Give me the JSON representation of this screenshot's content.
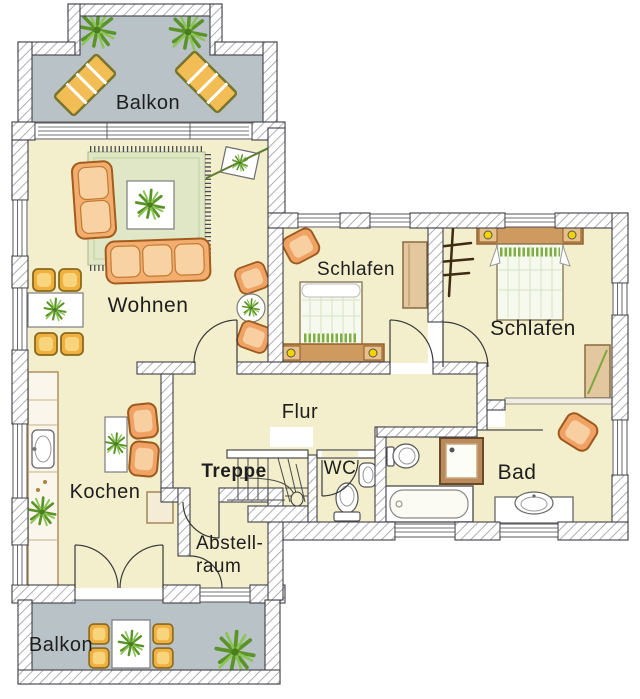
{
  "labels": {
    "balkon_top": "Balkon",
    "wohnen": "Wohnen",
    "schlafen_small": "Schlafen",
    "schlafen_large": "Schlafen",
    "flur": "Flur",
    "treppe": "Treppe",
    "wc": "WC",
    "bad": "Bad",
    "kochen": "Kochen",
    "abstellraum_line1": "Abstell-",
    "abstellraum_line2": "raum",
    "balkon_bottom": "Balkon"
  },
  "colors": {
    "room_floor": "#f3eecb",
    "balcony_floor": "#b9c3c7",
    "rug_green": "#dfe7c6",
    "furniture_orange": "#f0a264",
    "chair_yellow": "#f0b040",
    "wood_tan": "#e3c79e",
    "plant_green": "#5a9428",
    "lamp_yellow": "#f2d400",
    "wall_outline": "#3f3f46",
    "text": "#1e1e1e"
  }
}
